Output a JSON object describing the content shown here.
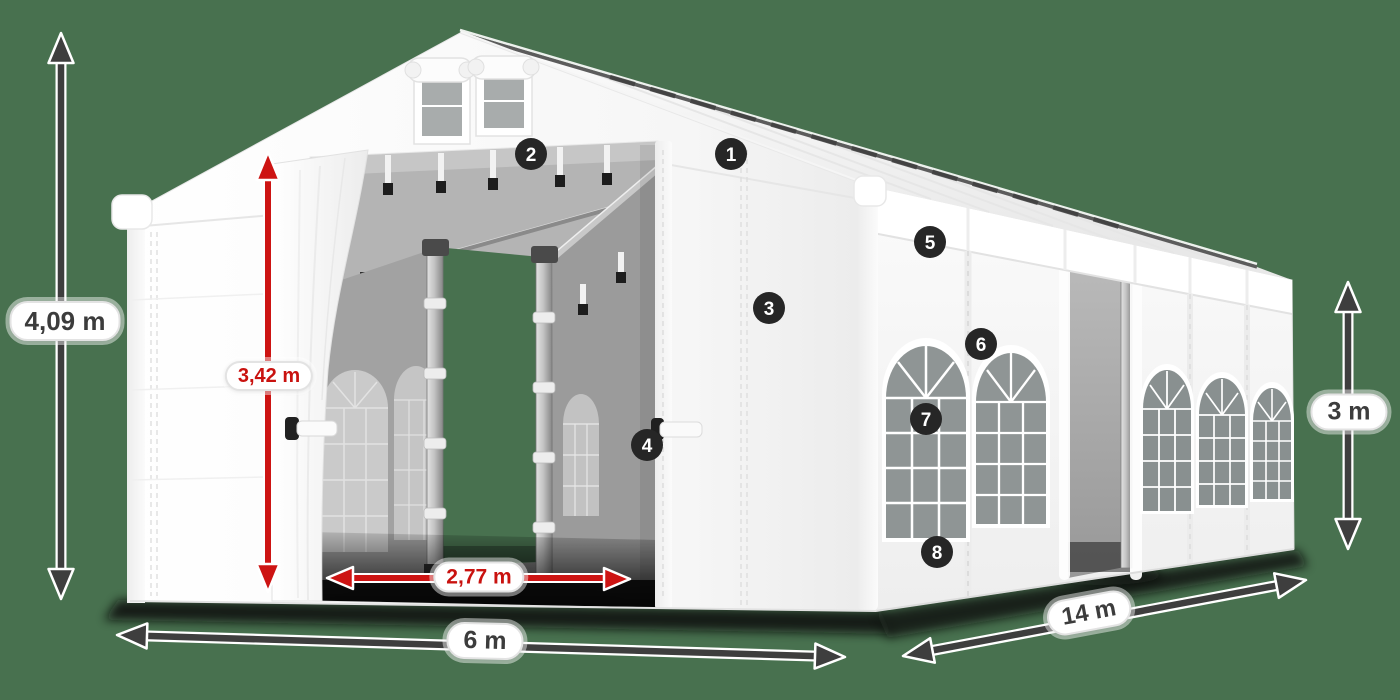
{
  "scene": {
    "description": "white storage marquee tent 6x14 m, three-quarter front-left view, numbered feature hotspots and dimension arrows",
    "background_color": "#48714F",
    "tent_color": "#ffffff",
    "red_accent": "#cd1413",
    "dimension_gray": "#3e3e3e",
    "badge_color": "#262626"
  },
  "labels": {
    "total_height": "4,09 m",
    "inner_height": "3,42 m",
    "door_width": "2,77 m",
    "front_width": "6 m",
    "side_length": "14 m",
    "wall_height": "3 m"
  },
  "badges": [
    {
      "number": "1"
    },
    {
      "number": "2"
    },
    {
      "number": "3"
    },
    {
      "number": "4"
    },
    {
      "number": "5"
    },
    {
      "number": "6"
    },
    {
      "number": "7"
    },
    {
      "number": "8"
    }
  ]
}
